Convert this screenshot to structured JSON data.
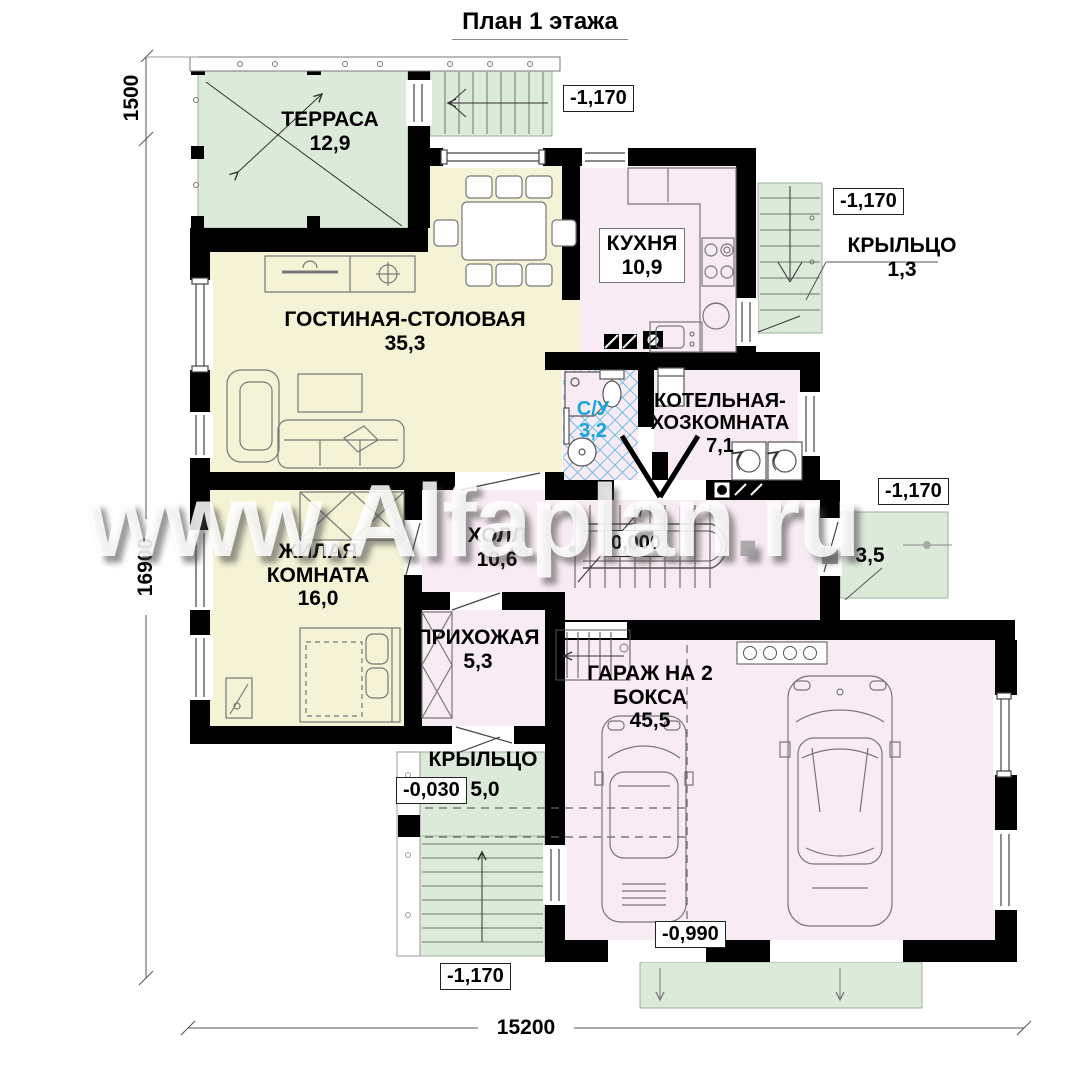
{
  "title": "План 1 этажа",
  "watermark": {
    "before_dot": "www.Alfaplan",
    "dot": ".",
    "after_dot": "ru"
  },
  "rooms": {
    "terrace": {
      "name": "ТЕРРАСА",
      "area": "12,9"
    },
    "living_dining": {
      "name": "ГОСТИНАЯ-СТОЛОВАЯ",
      "area": "35,3"
    },
    "kitchen": {
      "name": "КУХНЯ",
      "area": "10,9"
    },
    "bathroom": {
      "name": "С/У",
      "area": "3,2"
    },
    "boiler": {
      "line1": "КОТЕЛЬНАЯ-",
      "line2": "ХОЗКОМНАТА",
      "area": "7,1"
    },
    "living_room": {
      "line1": "ЖИЛАЯ",
      "line2": "КОМНАТА",
      "area": "16,0"
    },
    "hall": {
      "name": "ХОЛЛ",
      "area": "10,6"
    },
    "entry": {
      "name": "ПРИХОЖАЯ",
      "area": "5,3"
    },
    "garage": {
      "line1": "ГАРАЖ НА 2",
      "line2": "БОКСА",
      "area": "45,5"
    },
    "porch_right_top": {
      "name": "КРЫЛЬЦО",
      "area": "1,3"
    },
    "porch_left": {
      "name": "КРЫЛЬЦО",
      "area": "5,0"
    },
    "porch_right_mid": {
      "area": "3,5"
    }
  },
  "elevations": {
    "top_entry": "-1,170",
    "right_top": "-1,170",
    "right_mid": "-1,170",
    "hall_zero": "0,000",
    "porch_left": "-0,030",
    "garage": "-0,990",
    "bottom_left": "-1,170"
  },
  "dimensions": {
    "terrace_depth": "1500",
    "side_total": "16900",
    "bottom_total": "15200"
  },
  "colors": {
    "porch_green": "#dcead9",
    "room_yellow": "#f5f3d5",
    "room_pink": "#f8ebf3",
    "wall_black": "#000000",
    "tile_hatch_blue": "#45b2e4",
    "bathroom_label_blue": "#16a5e0"
  }
}
